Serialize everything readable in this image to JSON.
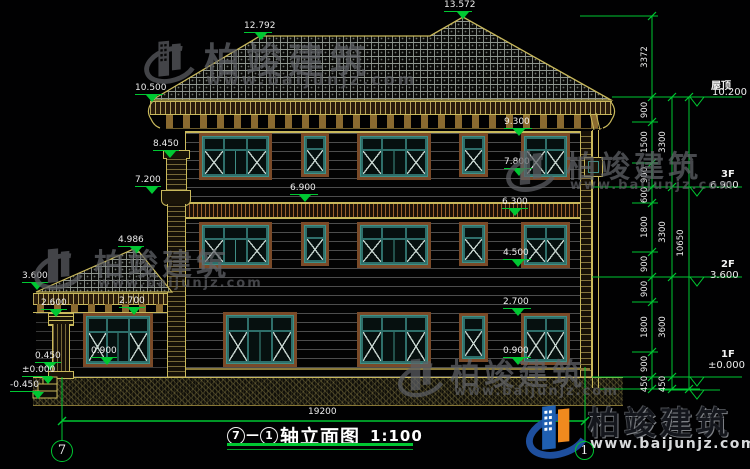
{
  "drawing": {
    "title": {
      "axis_from": "7",
      "sep": "—",
      "axis_to": "1",
      "name": "轴立面图",
      "scale": "1:100"
    },
    "total_width_dim": "19200",
    "axis_bubbles": {
      "left": "7",
      "right": "1"
    },
    "floor_flags": [
      {
        "name": "屋顶",
        "value": "10.200"
      },
      {
        "name": "3F",
        "value": "6.900"
      },
      {
        "name": "2F",
        "value": "3.600"
      },
      {
        "name": "1F",
        "value": "±0.000"
      }
    ],
    "elevation_marks": [
      {
        "id": "peak",
        "label": "13.572"
      },
      {
        "id": "ridge2",
        "label": "12.792"
      },
      {
        "id": "eave",
        "label": "10.500"
      },
      {
        "id": "chimney_top",
        "label": "8.450"
      },
      {
        "id": "chimney_corbel",
        "label": "7.200"
      },
      {
        "id": "porch_ridge",
        "label": "4.986"
      },
      {
        "id": "porch_eave",
        "label": "3.600"
      },
      {
        "id": "porch_beam_bottom",
        "label": "2.600"
      },
      {
        "id": "porch_beam_top",
        "label": "2.700"
      },
      {
        "id": "porch_sill",
        "label": "0.900"
      },
      {
        "id": "porch_platform",
        "label": "0.450"
      },
      {
        "id": "zero",
        "label": "±0.000"
      },
      {
        "id": "minus_0450",
        "label": "-0.450"
      },
      {
        "id": "w3_head",
        "label": "9.300"
      },
      {
        "id": "w3_sill",
        "label": "7.800"
      },
      {
        "id": "f3_level",
        "label": "6.900"
      },
      {
        "id": "band_top",
        "label": "6.300"
      },
      {
        "id": "w2_sill",
        "label": "4.500"
      },
      {
        "id": "w1_head",
        "label": "2.700"
      },
      {
        "id": "w1_sill",
        "label": "0.900"
      }
    ],
    "dim_chains": {
      "inner": [
        "3372",
        "900",
        "1500",
        "900",
        "600",
        "1800",
        "900",
        "900",
        "1800",
        "900",
        "450"
      ],
      "middle": [
        "3300",
        "3300",
        "3600",
        "450"
      ],
      "outer": [
        "10650"
      ]
    }
  },
  "watermark": {
    "brand": "柏竣建筑",
    "url": "www.baijunjz.com"
  },
  "colors": {
    "dim_green": "#00c832",
    "line_yellow": "#c9b95c",
    "trim_brown": "#7a4a28",
    "frame_teal": "#3f8f86",
    "text_white": "#ececec",
    "logo_blue": "#1f5fb0",
    "logo_orange": "#f08a1e"
  }
}
